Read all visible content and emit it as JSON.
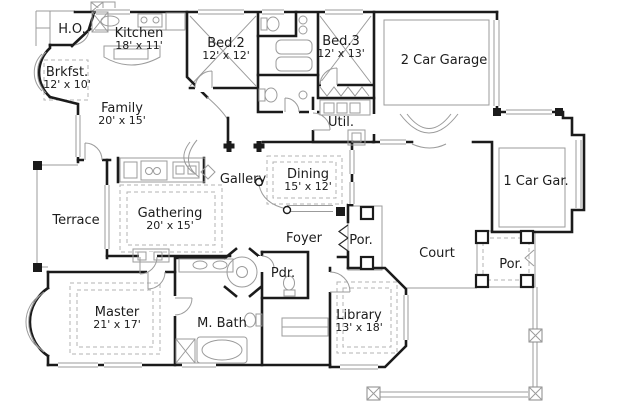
{
  "plan": {
    "type": "single-story-house-floor-plan",
    "colors": {
      "wall": "#1b1b1b",
      "thin_detail": "#9b9b9b",
      "ceiling_dash": "#b3b3b3",
      "text": "#1c1c1c",
      "background": "#ffffff"
    },
    "rooms": [
      {
        "id": "ho",
        "name": "H.O.",
        "dims": ""
      },
      {
        "id": "kitchen",
        "name": "Kitchen",
        "dims": "18' x 11'"
      },
      {
        "id": "brkfst",
        "name": "Brkfst.",
        "dims": "12' x 10'"
      },
      {
        "id": "bed2",
        "name": "Bed.2",
        "dims": "12' x 12'"
      },
      {
        "id": "bed3",
        "name": "Bed.3",
        "dims": "12' x 13'"
      },
      {
        "id": "garage2",
        "name": "2 Car Garage",
        "dims": ""
      },
      {
        "id": "family",
        "name": "Family",
        "dims": "20' x 15'"
      },
      {
        "id": "util",
        "name": "Util.",
        "dims": ""
      },
      {
        "id": "garage1",
        "name": "1 Car Gar.",
        "dims": ""
      },
      {
        "id": "gallery",
        "name": "Gallery",
        "dims": ""
      },
      {
        "id": "dining",
        "name": "Dining",
        "dims": "15' x 12'"
      },
      {
        "id": "terrace",
        "name": "Terrace",
        "dims": ""
      },
      {
        "id": "gathering",
        "name": "Gathering",
        "dims": "20' x 15'"
      },
      {
        "id": "foyer",
        "name": "Foyer",
        "dims": ""
      },
      {
        "id": "porch_entry",
        "name": "Por.",
        "dims": ""
      },
      {
        "id": "court",
        "name": "Court",
        "dims": ""
      },
      {
        "id": "porch_side",
        "name": "Por.",
        "dims": ""
      },
      {
        "id": "master",
        "name": "Master",
        "dims": "21' x 17'"
      },
      {
        "id": "mbath",
        "name": "M. Bath",
        "dims": ""
      },
      {
        "id": "pdr",
        "name": "Pdr.",
        "dims": ""
      },
      {
        "id": "library",
        "name": "Library",
        "dims": "13' x 18'"
      }
    ]
  }
}
